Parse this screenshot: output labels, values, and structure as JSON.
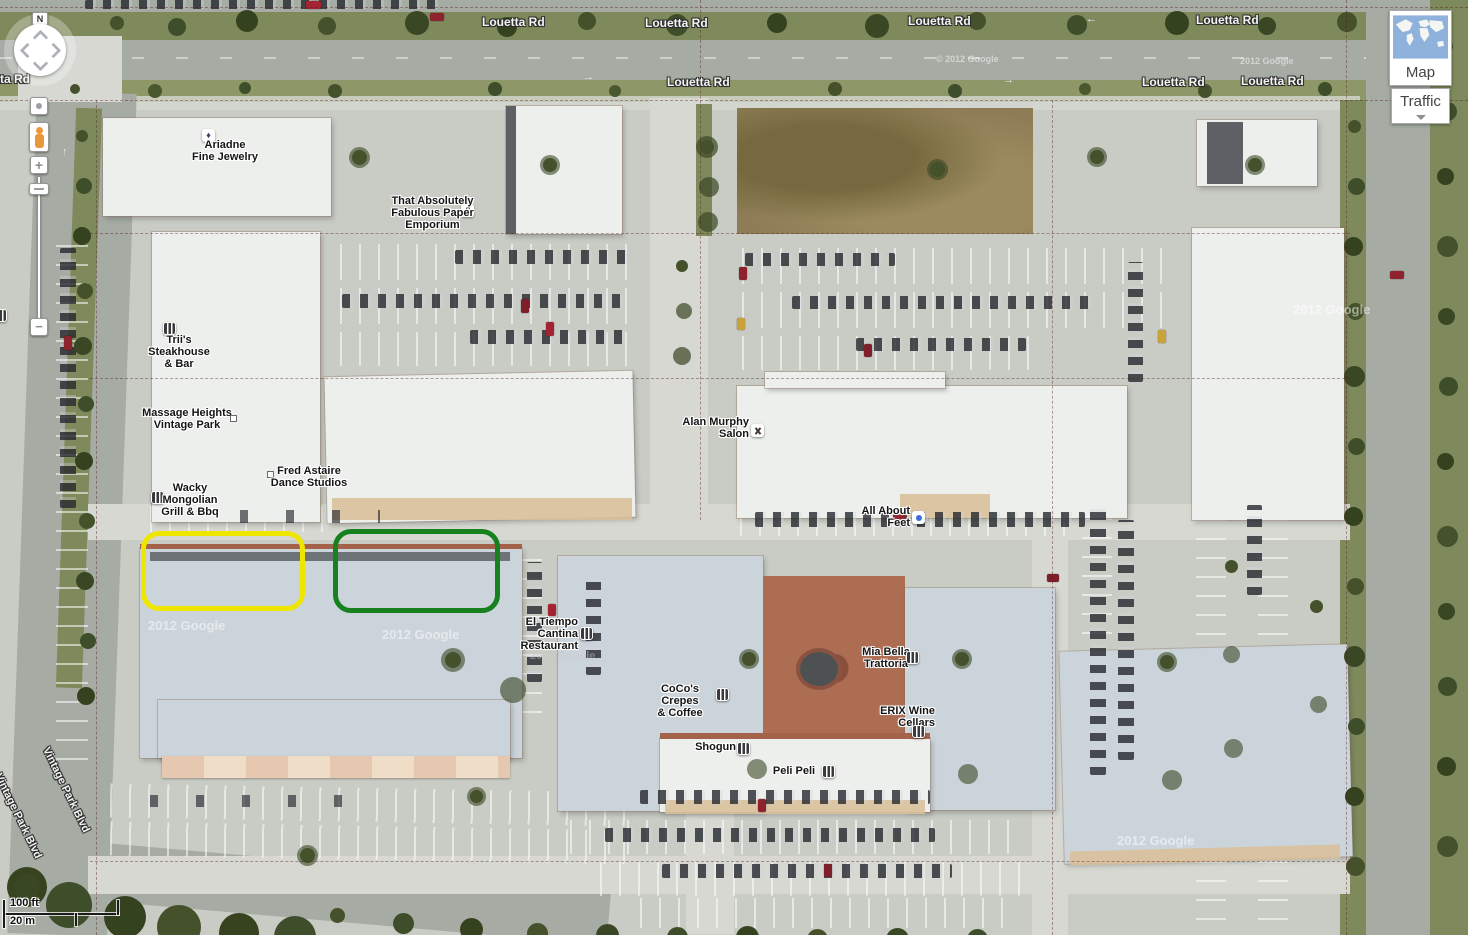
{
  "controls": {
    "north": "N",
    "zoom_in": "+",
    "zoom_out": "−",
    "map_button": "Map",
    "traffic_button": "Traffic"
  },
  "scale": {
    "imperial": "100 ft",
    "metric": "20 m"
  },
  "roads": {
    "louetta": "Louetta Rd",
    "louetta_partial": "tta Rd",
    "vintage": "Vintage Park Blvd"
  },
  "poi": {
    "ariadne": "Ariadne\nFine Jewelry",
    "paper": "That Absolutely\nFabulous Paper\nEmporium",
    "triis": "Trii's\nSteakhouse\n& Bar",
    "massage": "Massage Heights\nVintage Park",
    "fred": "Fred Astaire\nDance Studios",
    "wacky": "Wacky\nMongolian\nGrill & Bbq",
    "alan": "Alan Murphy\nSalon",
    "feet": "All About\nFeet",
    "eltiempo": "El Tiempo\nCantina\nRestaurant",
    "coco": "CoCo's Crepes\n& Coffee",
    "miabella": "Mia Bella\nTrattoria",
    "erix": "ERIX Wine\nCellars",
    "shogun": "Shogun",
    "peli": "Peli Peli"
  },
  "watermarks": {
    "google": "2012 Google",
    "google_c": "© 2012 Google"
  },
  "markings": {
    "arrow_right": "→",
    "arrow_left": "←",
    "arrow_up": "↑"
  },
  "icons": {
    "gem": "♦"
  },
  "highlights": {
    "yellow": "#efe600",
    "green": "#17801f"
  }
}
